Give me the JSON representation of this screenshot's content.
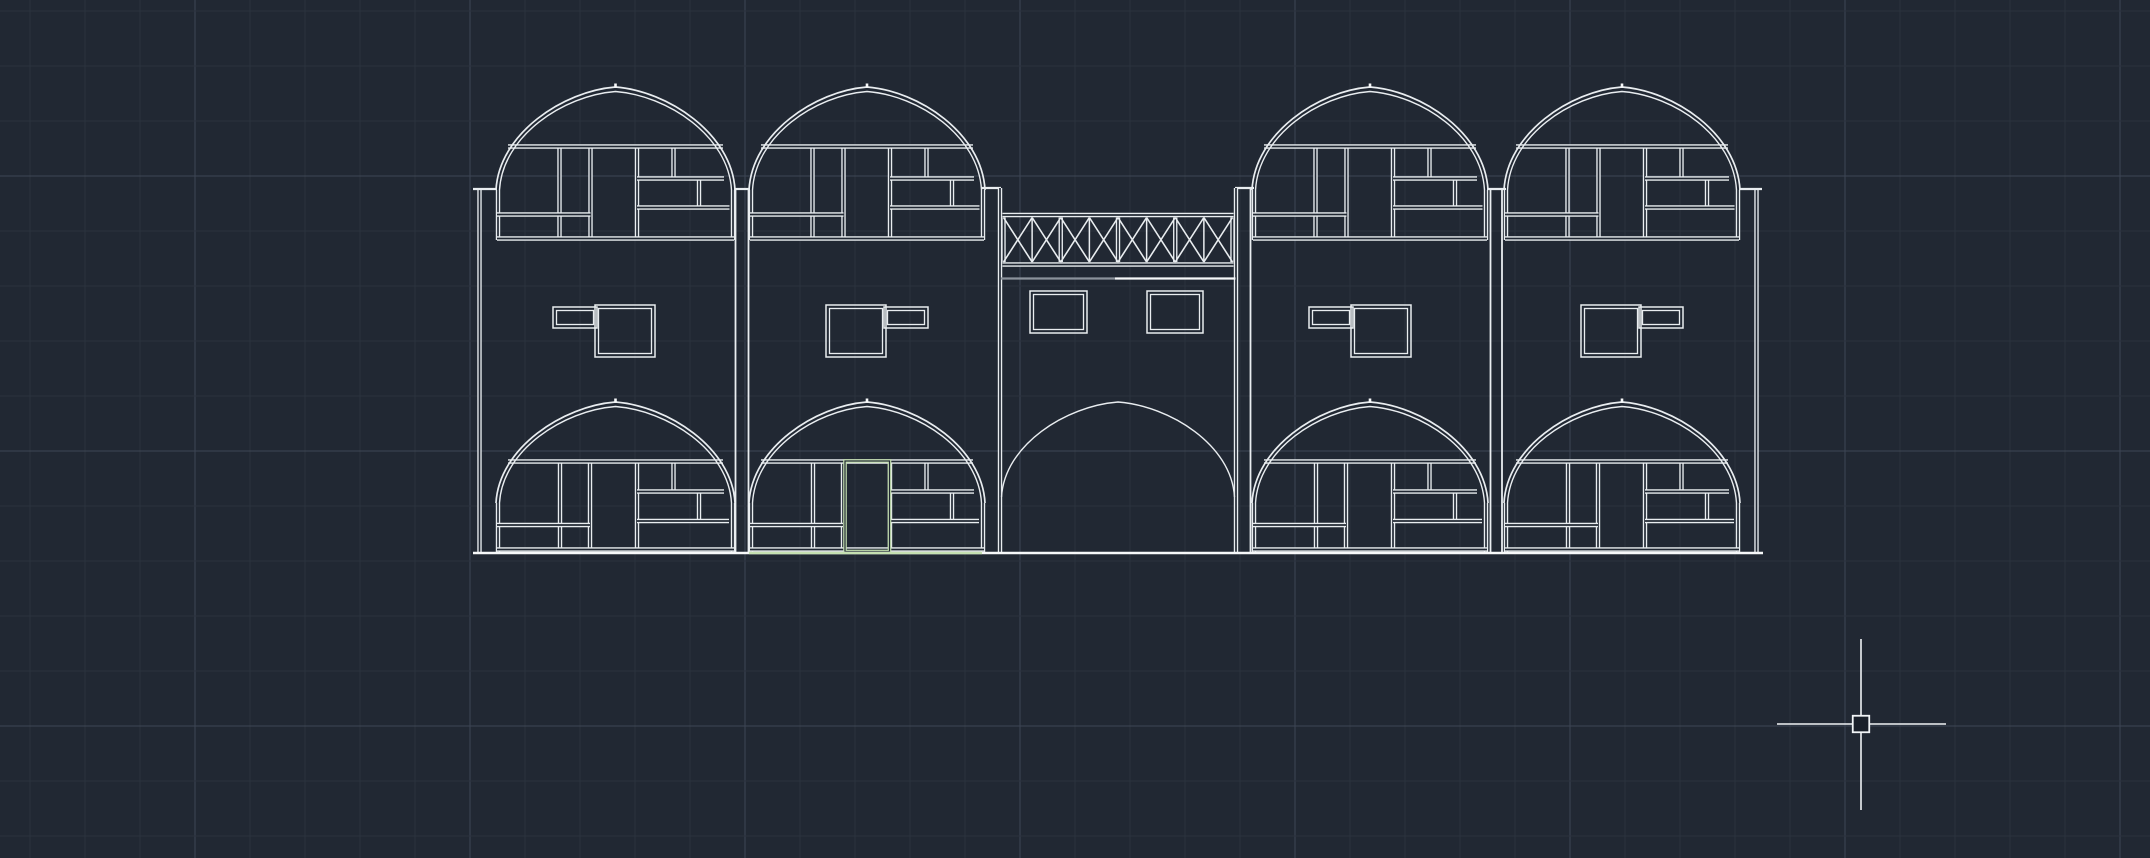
{
  "app": {
    "type": "cad-model-space-viewport",
    "description": "Dark CAD drawing area showing an architectural front elevation of a four-bay domed building with a central arched gateway, plus crosshair cursor with pickbox"
  },
  "canvas": {
    "width": 2150,
    "height": 858,
    "background": "#212833"
  },
  "palette": {
    "line": "#e9edf0",
    "bright": "#f6f8f9",
    "gray_line": "#8b929b",
    "green_highlight": "#c5e0b1",
    "grid_minor": "#2b323e",
    "grid_major": "#3d4654",
    "pickbox_fill": "#1a202a"
  },
  "grid": {
    "origin_x": 30,
    "origin_y": 11,
    "spacing": 55,
    "major_xs": [
      195,
      470,
      745,
      1020,
      1295,
      1570,
      1845,
      2120
    ],
    "major_ys": [
      176,
      451,
      726
    ]
  },
  "crosshair": {
    "x": 1861,
    "y": 724,
    "h_from": 1777,
    "h_to": 1946,
    "v_from": 639,
    "v_to": 810,
    "pickbox_size": 16.5
  },
  "facade": {
    "baseline": {
      "y": 553,
      "x_from": 473,
      "x_to": 1763,
      "green_from": 749,
      "green_to": 982
    },
    "outer_walls": [
      {
        "x": 479.5,
        "top": 189
      },
      {
        "x": 1756.5,
        "top": 189
      }
    ],
    "gap_walls": [
      {
        "x1": 735.5,
        "x2": 748.5,
        "top": 189
      },
      {
        "x1": 982.0,
        "x2": 999.5,
        "top": 188,
        "skip_first": true
      },
      {
        "x1": 1236.5,
        "x2": 1250.5,
        "top": 188,
        "skip_first": true
      },
      {
        "x1": 1490.5,
        "x2": 1502.0,
        "top": 189
      }
    ],
    "caps": [
      {
        "x1": 473,
        "x2": 497,
        "y": 189
      },
      {
        "x1": 734,
        "x2": 750,
        "y": 189
      },
      {
        "x1": 981,
        "x2": 1001,
        "y": 188
      },
      {
        "x1": 1235,
        "x2": 1254,
        "y": 188
      },
      {
        "x1": 1487,
        "x2": 1506,
        "y": 189
      },
      {
        "x1": 1739,
        "x2": 1762,
        "y": 189
      }
    ],
    "bays": [
      {
        "name": "bay-1",
        "left": 496,
        "right": 735,
        "l_window_mirrored": false,
        "door": false
      },
      {
        "name": "bay-2",
        "left": 749,
        "right": 985,
        "l_window_mirrored": true,
        "door": true
      },
      {
        "name": "bay-3",
        "left": 1252,
        "right": 1488,
        "l_window_mirrored": false,
        "door": false
      },
      {
        "name": "bay-4",
        "left": 1504,
        "right": 1740,
        "l_window_mirrored": true,
        "door": false
      }
    ],
    "top_window": {
      "spring_y": 190,
      "peak_y": 87,
      "verticals": [
        {
          "u": 2,
          "y1": 190,
          "y2": 240
        },
        {
          "r": 2,
          "y1": 190,
          "y2": 240
        },
        {
          "u": 63.5,
          "y1": 148,
          "y2": 238
        },
        {
          "u": 94.5,
          "y1": 148,
          "y2": 238
        },
        {
          "u": 141,
          "y1": 148,
          "y2": 238
        },
        {
          "u": 177.5,
          "y1": 148,
          "y2": 179
        },
        {
          "u": 203,
          "y1": 179,
          "y2": 208
        }
      ],
      "horizontals": [
        {
          "u1": 12,
          "r2": 12,
          "y": 146.5
        },
        {
          "u1": 141,
          "r2": 11,
          "y": 178.5
        },
        {
          "u1": 141,
          "r2": 5.5,
          "y": 207.5
        },
        {
          "u1": 1,
          "u2": 94.5,
          "y": 214.5
        },
        {
          "u1": 1,
          "r2": 1,
          "y": 238.5
        }
      ]
    },
    "lower_window": {
      "spring_y": 503,
      "peak_y": 402,
      "verticals": [
        {
          "u": 2,
          "y1": 503,
          "y2": 552.5
        },
        {
          "r": 2,
          "y1": 503,
          "y2": 552.5
        },
        {
          "u": 64,
          "y1": 463,
          "y2": 550.5
        },
        {
          "u": 94,
          "y1": 463,
          "y2": 550.5
        },
        {
          "u": 141,
          "y1": 463,
          "y2": 550.5
        },
        {
          "u": 177.5,
          "y1": 463,
          "y2": 492.5
        },
        {
          "u": 203,
          "y1": 492.5,
          "y2": 521.5
        }
      ],
      "horizontals": [
        {
          "u1": 12,
          "r2": 12,
          "y": 461.5
        },
        {
          "u1": 141,
          "r2": 11,
          "y": 491.5
        },
        {
          "u1": 141,
          "r2": 6,
          "y": 521
        },
        {
          "u1": 1,
          "u2": 94,
          "y": 525
        },
        {
          "u1": 1,
          "r2": 1,
          "y": 549.5
        }
      ]
    },
    "l_window": {
      "small": {
        "u1": 57,
        "y1": 307,
        "u2": 101,
        "y2": 328
      },
      "big": {
        "u1": 99,
        "y1": 305,
        "u2": 159,
        "y2": 357
      }
    },
    "door": {
      "u1": 96,
      "u2": 140.5,
      "y1": 461,
      "y2": 551.5
    },
    "central": {
      "wall_left": 1000,
      "wall_right": 1236,
      "wall_top": 188,
      "truss": {
        "x1": 1003.5,
        "x2": 1232.5,
        "chord_top_y": 215,
        "chord_bottom_y": 264.5,
        "web_y1": 217.5,
        "web_y2": 262,
        "cells": 8
      },
      "sub_line": {
        "y": 278.5,
        "gray_x1": 1001,
        "gray_x2": 1115,
        "white_x1": 1115,
        "white_x2": 1235.5
      },
      "windows": [
        {
          "x": 1030,
          "y": 291,
          "w": 57,
          "h": 42
        },
        {
          "x": 1147,
          "y": 291,
          "w": 56,
          "h": 42
        }
      ],
      "arch": {
        "x1": 1001.5,
        "x2": 1234.5,
        "spring_y": 497,
        "peak_y": 402
      }
    }
  }
}
